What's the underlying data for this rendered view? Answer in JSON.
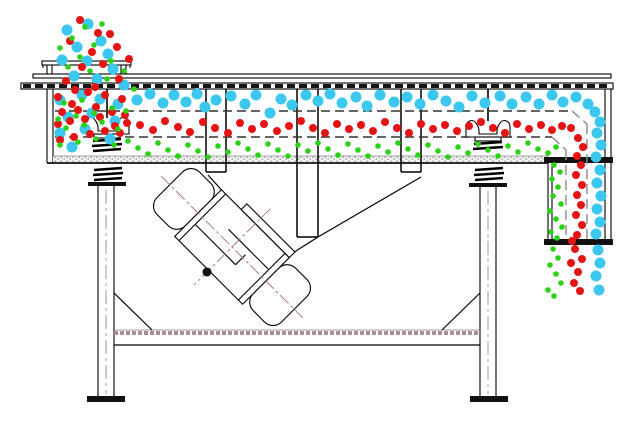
{
  "diagram": {
    "title": "linear-vibrating-screen-particle-flow-section",
    "background": "#ffffff",
    "line_color": "#000000",
    "particle_legend": [
      {
        "name": "coarse-oversize-particles",
        "color": "#3cc8ee",
        "radius": 5.5
      },
      {
        "name": "medium-midsize-particles",
        "color": "#e51313",
        "radius": 4.0
      },
      {
        "name": "fine-undersize-particles",
        "color": "#2bd214",
        "radius": 2.8
      }
    ],
    "particles": {
      "coarse": [
        [
          67,
          30
        ],
        [
          88,
          24
        ],
        [
          77,
          47
        ],
        [
          101,
          41
        ],
        [
          62,
          60
        ],
        [
          87,
          61
        ],
        [
          108,
          54
        ],
        [
          74,
          76
        ],
        [
          97,
          79
        ],
        [
          113,
          69
        ],
        [
          124,
          85
        ],
        [
          60,
          100
        ],
        [
          82,
          95
        ],
        [
          100,
          99
        ],
        [
          118,
          104
        ],
        [
          68,
          117
        ],
        [
          92,
          113
        ],
        [
          115,
          121
        ],
        [
          60,
          133
        ],
        [
          85,
          129
        ],
        [
          110,
          139
        ],
        [
          72,
          147
        ],
        [
          137,
          100
        ],
        [
          150,
          94
        ],
        [
          163,
          103
        ],
        [
          174,
          95
        ],
        [
          186,
          102
        ],
        [
          197,
          94
        ],
        [
          205,
          107
        ],
        [
          216,
          100
        ],
        [
          231,
          96
        ],
        [
          245,
          104
        ],
        [
          256,
          95
        ],
        [
          270,
          113
        ],
        [
          281,
          99
        ],
        [
          292,
          105
        ],
        [
          306,
          95
        ],
        [
          318,
          101
        ],
        [
          330,
          94
        ],
        [
          342,
          103
        ],
        [
          356,
          97
        ],
        [
          367,
          106
        ],
        [
          380,
          95
        ],
        [
          394,
          102
        ],
        [
          407,
          97
        ],
        [
          420,
          104
        ],
        [
          433,
          95
        ],
        [
          446,
          101
        ],
        [
          459,
          107
        ],
        [
          472,
          96
        ],
        [
          485,
          103
        ],
        [
          500,
          96
        ],
        [
          512,
          104
        ],
        [
          526,
          97
        ],
        [
          539,
          104
        ],
        [
          552,
          95
        ],
        [
          563,
          102
        ],
        [
          576,
          97
        ],
        [
          588,
          104
        ],
        [
          595,
          112
        ],
        [
          600,
          122
        ],
        [
          597,
          133
        ],
        [
          601,
          145
        ],
        [
          596,
          157
        ],
        [
          600,
          170
        ],
        [
          597,
          183
        ],
        [
          601,
          196
        ],
        [
          597,
          209
        ],
        [
          600,
          222
        ],
        [
          596,
          234
        ],
        [
          598,
          250
        ],
        [
          600,
          263
        ],
        [
          596,
          276
        ],
        [
          599,
          290
        ]
      ],
      "medium": [
        [
          80,
          20
        ],
        [
          98,
          33
        ],
        [
          70,
          41
        ],
        [
          92,
          52
        ],
        [
          110,
          34
        ],
        [
          82,
          67
        ],
        [
          103,
          64
        ],
        [
          117,
          47
        ],
        [
          66,
          81
        ],
        [
          95,
          87
        ],
        [
          119,
          79
        ],
        [
          129,
          59
        ],
        [
          75,
          90
        ],
        [
          58,
          97
        ],
        [
          72,
          104
        ],
        [
          88,
          92
        ],
        [
          105,
          95
        ],
        [
          122,
          99
        ],
        [
          62,
          112
        ],
        [
          78,
          110
        ],
        [
          96,
          107
        ],
        [
          112,
          112
        ],
        [
          125,
          115
        ],
        [
          58,
          124
        ],
        [
          70,
          121
        ],
        [
          85,
          119
        ],
        [
          100,
          117
        ],
        [
          115,
          126
        ],
        [
          127,
          123
        ],
        [
          60,
          140
        ],
        [
          74,
          137
        ],
        [
          90,
          134
        ],
        [
          105,
          131
        ],
        [
          120,
          133
        ],
        [
          140,
          125
        ],
        [
          153,
          130
        ],
        [
          165,
          121
        ],
        [
          178,
          127
        ],
        [
          190,
          132
        ],
        [
          203,
          122
        ],
        [
          215,
          128
        ],
        [
          228,
          133
        ],
        [
          240,
          123
        ],
        [
          252,
          129
        ],
        [
          264,
          124
        ],
        [
          277,
          131
        ],
        [
          289,
          126
        ],
        [
          301,
          121
        ],
        [
          313,
          128
        ],
        [
          325,
          133
        ],
        [
          337,
          124
        ],
        [
          349,
          129
        ],
        [
          361,
          125
        ],
        [
          373,
          131
        ],
        [
          385,
          122
        ],
        [
          397,
          128
        ],
        [
          409,
          133
        ],
        [
          421,
          124
        ],
        [
          433,
          129
        ],
        [
          445,
          125
        ],
        [
          457,
          131
        ],
        [
          469,
          126
        ],
        [
          481,
          122
        ],
        [
          493,
          128
        ],
        [
          505,
          133
        ],
        [
          517,
          124
        ],
        [
          529,
          129
        ],
        [
          541,
          125
        ],
        [
          552,
          130
        ],
        [
          562,
          126
        ],
        [
          571,
          128
        ],
        [
          578,
          138
        ],
        [
          583,
          147
        ],
        [
          577,
          156
        ],
        [
          581,
          165
        ],
        [
          576,
          175
        ],
        [
          582,
          185
        ],
        [
          577,
          195
        ],
        [
          581,
          205
        ],
        [
          576,
          215
        ],
        [
          582,
          225
        ],
        [
          577,
          235
        ],
        [
          572,
          241
        ],
        [
          575,
          249
        ],
        [
          582,
          259
        ],
        [
          571,
          263
        ],
        [
          578,
          272
        ],
        [
          574,
          283
        ],
        [
          580,
          291
        ]
      ],
      "fine": [
        [
          85,
          27
        ],
        [
          72,
          38
        ],
        [
          102,
          24
        ],
        [
          94,
          45
        ],
        [
          80,
          57
        ],
        [
          111,
          61
        ],
        [
          90,
          71
        ],
        [
          68,
          67
        ],
        [
          107,
          79
        ],
        [
          124,
          71
        ],
        [
          134,
          89
        ],
        [
          60,
          48
        ],
        [
          64,
          103
        ],
        [
          82,
          100
        ],
        [
          58,
          119
        ],
        [
          76,
          116
        ],
        [
          94,
          113
        ],
        [
          112,
          108
        ],
        [
          126,
          111
        ],
        [
          66,
          128
        ],
        [
          84,
          125
        ],
        [
          102,
          122
        ],
        [
          118,
          129
        ],
        [
          60,
          145
        ],
        [
          78,
          142
        ],
        [
          96,
          139
        ],
        [
          114,
          145
        ],
        [
          128,
          141
        ],
        [
          138,
          148
        ],
        [
          148,
          154
        ],
        [
          158,
          143
        ],
        [
          168,
          150
        ],
        [
          178,
          156
        ],
        [
          188,
          145
        ],
        [
          198,
          151
        ],
        [
          208,
          157
        ],
        [
          218,
          146
        ],
        [
          228,
          152
        ],
        [
          238,
          143
        ],
        [
          248,
          149
        ],
        [
          258,
          155
        ],
        [
          268,
          144
        ],
        [
          278,
          150
        ],
        [
          288,
          156
        ],
        [
          298,
          145
        ],
        [
          308,
          151
        ],
        [
          318,
          143
        ],
        [
          328,
          149
        ],
        [
          338,
          155
        ],
        [
          348,
          144
        ],
        [
          358,
          150
        ],
        [
          368,
          156
        ],
        [
          378,
          146
        ],
        [
          388,
          152
        ],
        [
          398,
          143
        ],
        [
          408,
          149
        ],
        [
          418,
          155
        ],
        [
          428,
          145
        ],
        [
          438,
          151
        ],
        [
          448,
          157
        ],
        [
          458,
          147
        ],
        [
          468,
          153
        ],
        [
          478,
          144
        ],
        [
          488,
          150
        ],
        [
          498,
          156
        ],
        [
          508,
          146
        ],
        [
          518,
          152
        ],
        [
          528,
          143
        ],
        [
          538,
          149
        ],
        [
          548,
          153
        ],
        [
          556,
          147
        ],
        [
          554,
          165
        ],
        [
          560,
          172
        ],
        [
          552,
          179
        ],
        [
          558,
          187
        ],
        [
          553,
          196
        ],
        [
          561,
          204
        ],
        [
          550,
          211
        ],
        [
          556,
          219
        ],
        [
          562,
          227
        ],
        [
          551,
          232
        ],
        [
          557,
          238
        ],
        [
          553,
          249
        ],
        [
          558,
          258
        ],
        [
          550,
          265
        ],
        [
          556,
          274
        ],
        [
          561,
          283
        ],
        [
          548,
          290
        ],
        [
          554,
          296
        ]
      ]
    }
  }
}
